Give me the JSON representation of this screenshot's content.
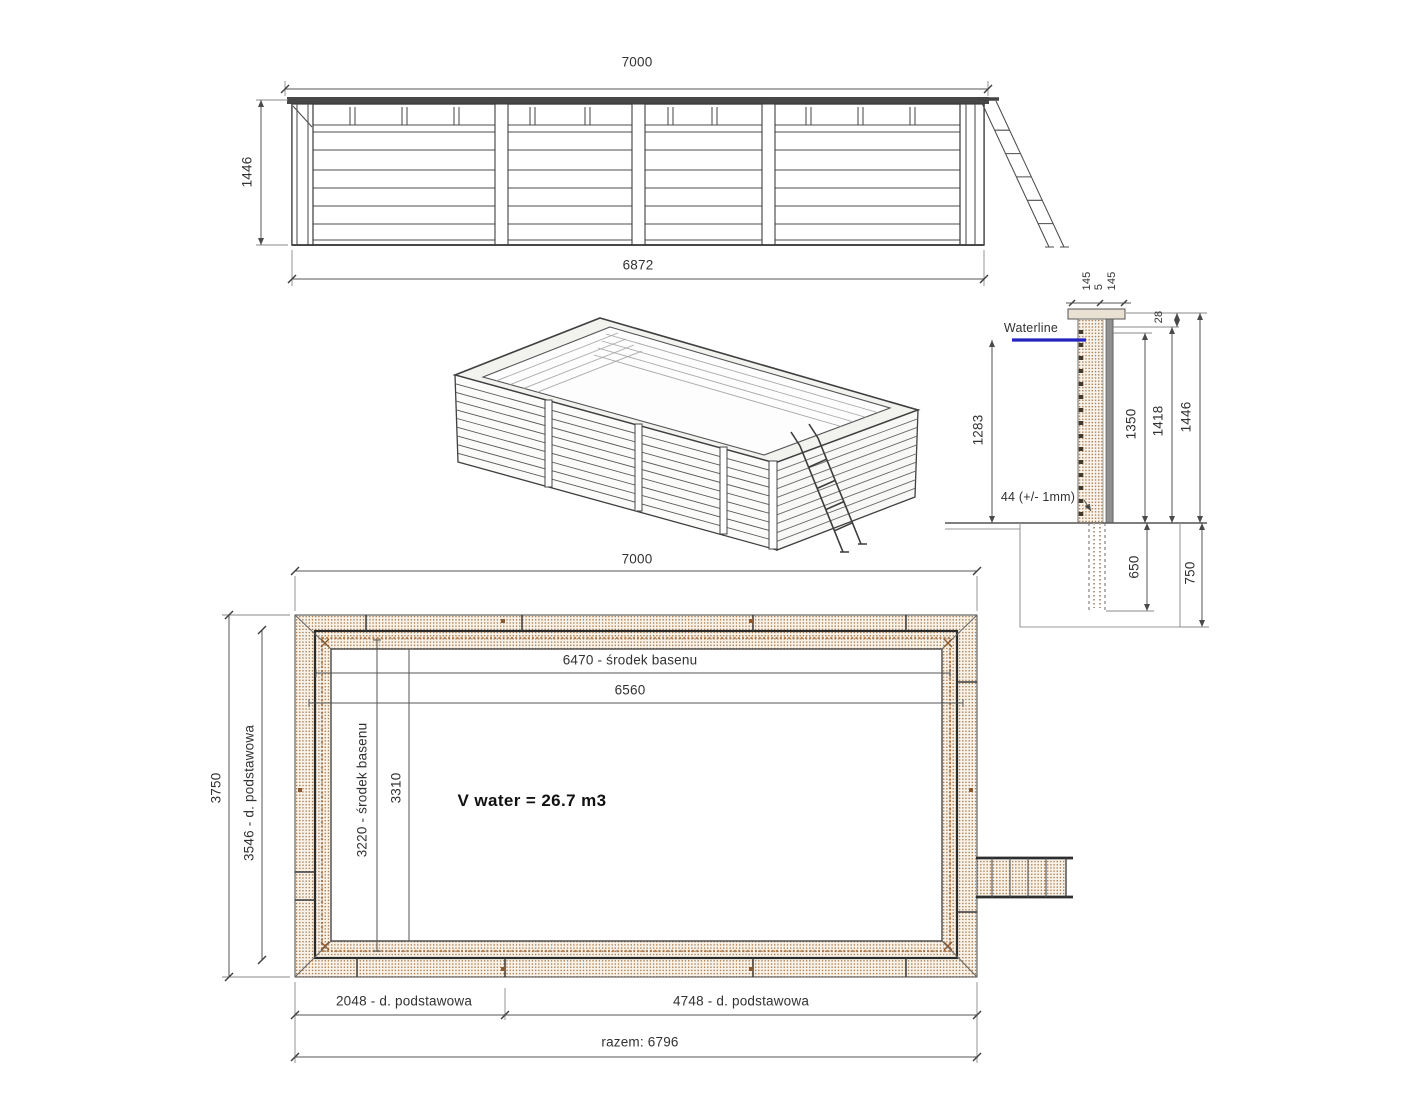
{
  "colors": {
    "waterline_blue": "#2323bd",
    "hatch_dot": "#ab7c50",
    "hatch_bg": "#f8f2e8",
    "line_dark": "#3a3a3a",
    "wall_brown": "#a06a3c"
  },
  "elevation": {
    "dim_top": "7000",
    "dim_left": "1446",
    "dim_bottom": "6872"
  },
  "section": {
    "waterline": "Waterline",
    "cap_left": "145",
    "cap_mid": "5",
    "cap_right": "145",
    "dim_28": "28",
    "dim_1283": "1283",
    "dim_1350": "1350",
    "dim_1418": "1418",
    "dim_1446": "1446",
    "note_44": "44 (+/- 1mm)",
    "dim_650": "650",
    "dim_750": "750"
  },
  "plan": {
    "dim_top": "7000",
    "dim_6470": "6470 - środek basenu",
    "dim_6560": "6560",
    "dim_3750": "3750",
    "dim_3546": "3546 - d. podstawowa",
    "dim_3220": "3220 - środek basenu",
    "dim_3310": "3310",
    "volume": "V water = 26.7 m3",
    "dim_2048": "2048 - d. podstawowa",
    "dim_4748": "4748 - d. podstawowa",
    "dim_total": "razem: 6796"
  }
}
